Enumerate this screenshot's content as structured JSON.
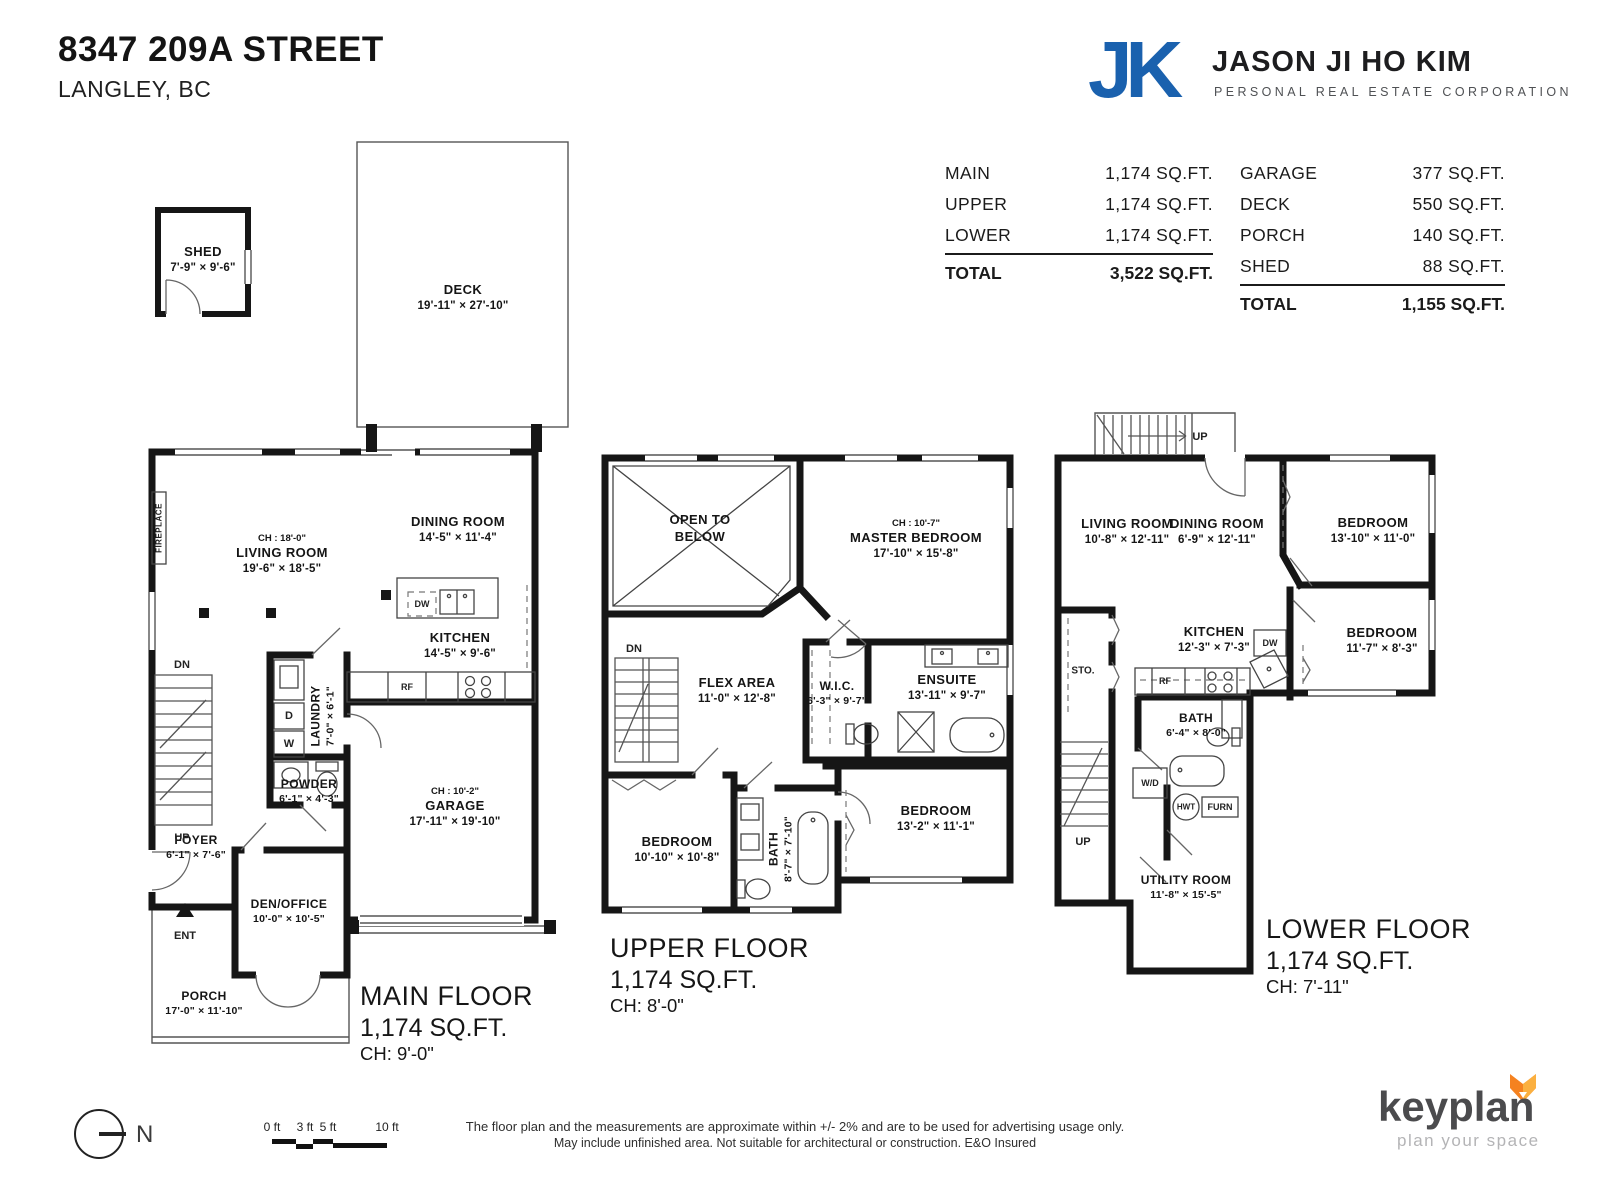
{
  "header": {
    "address": "8347 209A STREET",
    "city": "LANGLEY, BC"
  },
  "agent": {
    "monogram": "JK",
    "name": "JASON JI HO KIM",
    "tagline": "PERSONAL REAL ESTATE CORPORATION",
    "brand_blue": "#1a61ae"
  },
  "area_tables": {
    "floors": {
      "rows": [
        {
          "label": "MAIN",
          "value": "1,174 SQ.FT."
        },
        {
          "label": "UPPER",
          "value": "1,174 SQ.FT."
        },
        {
          "label": "LOWER",
          "value": "1,174 SQ.FT."
        }
      ],
      "total_label": "TOTAL",
      "total_value": "3,522 SQ.FT."
    },
    "other": {
      "rows": [
        {
          "label": "GARAGE",
          "value": "377 SQ.FT."
        },
        {
          "label": "DECK",
          "value": "550 SQ.FT."
        },
        {
          "label": "PORCH",
          "value": "140 SQ.FT."
        },
        {
          "label": "SHED",
          "value": "88 SQ.FT."
        }
      ],
      "total_label": "TOTAL",
      "total_value": "1,155 SQ.FT."
    }
  },
  "plans": {
    "main": {
      "shed": {
        "name": "SHED",
        "dims": "7'-9\" × 9'-6\""
      },
      "deck": {
        "name": "DECK",
        "dims": "19'-11\" × 27'-10\""
      },
      "living": {
        "ch": "CH : 18'-0\"",
        "name": "LIVING ROOM",
        "dims": "19'-6\" × 18'-5\""
      },
      "dining": {
        "name": "DINING ROOM",
        "dims": "14'-5\" × 11'-4\""
      },
      "kitchen": {
        "name": "KITCHEN",
        "dims": "14'-5\" × 9'-6\""
      },
      "laundry": {
        "name": "LAUNDRY",
        "dims": "7'-0\" × 6'-1\""
      },
      "powder": {
        "name": "POWDER",
        "dims": "6'-1\" × 4'-3\""
      },
      "garage": {
        "ch": "CH : 10'-2\"",
        "name": "GARAGE",
        "dims": "17'-11\" × 19'-10\""
      },
      "foyer": {
        "name": "FOYER",
        "dims": "6'-1\" × 7'-6\""
      },
      "den": {
        "name": "DEN/OFFICE",
        "dims": "10'-0\" × 10'-5\""
      },
      "porch": {
        "name": "PORCH",
        "dims": "17'-0\" × 11'-10\""
      },
      "markers": {
        "fireplace": "FIREPLACE",
        "dn": "DN",
        "up": "UP",
        "ent": "ENT",
        "d": "D",
        "w": "W",
        "dw": "DW",
        "rf": "RF"
      },
      "caption": {
        "title": "MAIN FLOOR",
        "area": "1,174 SQ.FT.",
        "ch": "CH: 9'-0\""
      }
    },
    "upper": {
      "open_below": {
        "line1": "OPEN TO",
        "line2": "BELOW"
      },
      "master": {
        "ch": "CH : 10'-7\"",
        "name": "MASTER BEDROOM",
        "dims": "17'-10\" × 15'-8\""
      },
      "flex": {
        "name": "FLEX AREA",
        "dims": "11'-0\" × 12'-8\""
      },
      "wic": {
        "name": "W.I.C.",
        "dims": "6'-3\" × 9'-7\""
      },
      "ensuite": {
        "name": "ENSUITE",
        "dims": "13'-11\" × 9'-7\""
      },
      "bedroom_left": {
        "name": "BEDROOM",
        "dims": "10'-10\" × 10'-8\""
      },
      "bath": {
        "name": "BATH",
        "dims": "8'-7\" × 7'-10\""
      },
      "bedroom_right": {
        "name": "BEDROOM",
        "dims": "13'-2\" × 11'-1\""
      },
      "markers": {
        "dn": "DN"
      },
      "caption": {
        "title": "UPPER FLOOR",
        "area": "1,174 SQ.FT.",
        "ch": "CH: 8'-0\""
      }
    },
    "lower": {
      "living": {
        "name": "LIVING ROOM",
        "dims": "10'-8\" × 12'-11\""
      },
      "dining": {
        "name": "DINING ROOM",
        "dims": "6'-9\" × 12'-11\""
      },
      "bedroom_top": {
        "name": "BEDROOM",
        "dims": "13'-10\" × 11'-0\""
      },
      "bedroom_bottom": {
        "name": "BEDROOM",
        "dims": "11'-7\" × 8'-3\""
      },
      "kitchen": {
        "name": "KITCHEN",
        "dims": "12'-3\" × 7'-3\""
      },
      "bath": {
        "name": "BATH",
        "dims": "6'-4\" × 8'-0\""
      },
      "utility": {
        "name": "UTILITY ROOM",
        "dims": "11'-8\" × 15'-5\""
      },
      "markers": {
        "sto": "STO.",
        "up_exterior": "UP",
        "up_interior": "UP",
        "wd": "W/D",
        "hwt": "HWT",
        "furn": "FURN",
        "dw": "DW",
        "rf": "RF"
      },
      "caption": {
        "title": "LOWER FLOOR",
        "area": "1,174 SQ.FT.",
        "ch": "CH: 7'-11\""
      }
    }
  },
  "footer": {
    "compass_label": "N",
    "scale_ticks": [
      "0 ft",
      "3 ft",
      "5 ft",
      "10 ft"
    ],
    "disclaimer_line1": "The floor plan and the measurements are approximate within +/- 2% and are to be used for advertising usage only.",
    "disclaimer_line2": "May include unfinished area. Not suitable for architectural or construction. E&O Insured",
    "brand": {
      "name": "keyplan",
      "tagline": "plan your space",
      "fox_orange": "#f58220",
      "fox_light": "#fbb040"
    }
  }
}
